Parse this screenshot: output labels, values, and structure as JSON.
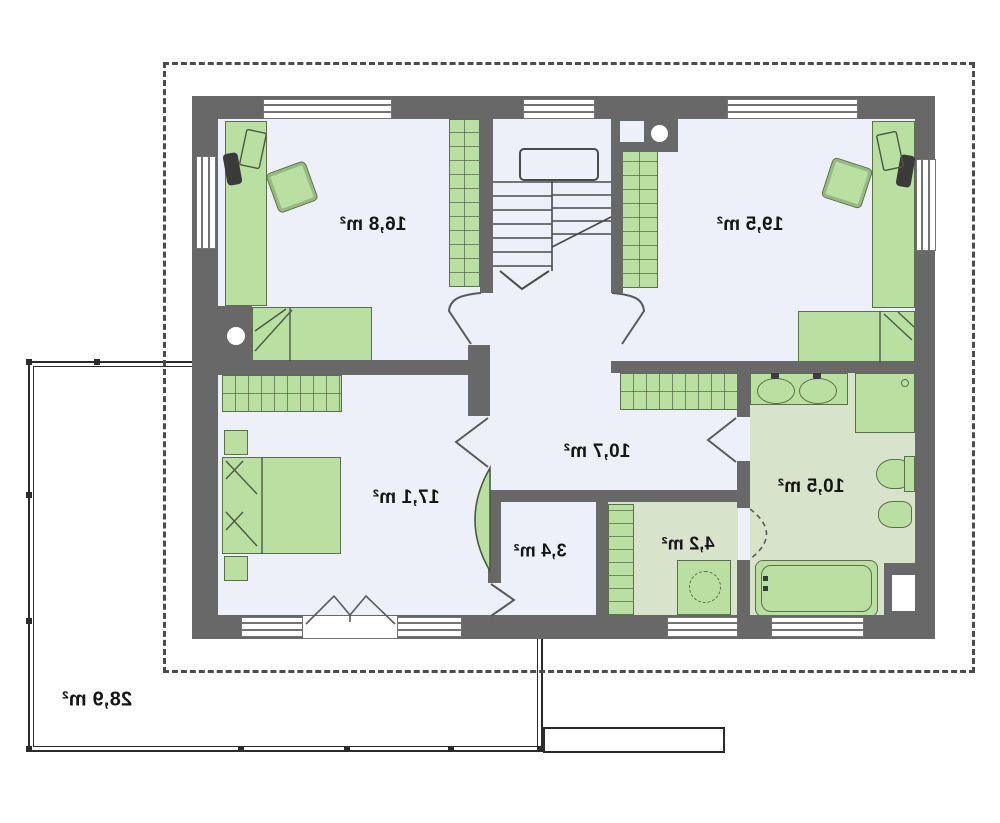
{
  "floor_plan": {
    "room_labels": [
      {
        "id": "room-top-left",
        "area": "16,8 m²"
      },
      {
        "id": "room-top-right",
        "area": "19,5 m²"
      },
      {
        "id": "room-bottom-left",
        "area": "17,1 m²"
      },
      {
        "id": "hall",
        "area": "10,7 m²"
      },
      {
        "id": "bathroom",
        "area": "10,5 m²"
      },
      {
        "id": "closet",
        "area": "3,4 m²"
      },
      {
        "id": "utility",
        "area": "4,2 m²"
      },
      {
        "id": "terrace",
        "area": "28,9 m²"
      }
    ],
    "text_mirrored": true,
    "colors": {
      "wall": "#686868",
      "room_floor": "#edf0f8",
      "wet_room_floor": "#d8e3cc",
      "furniture_fill": "#b9e0a1",
      "furniture_outline": "#5a7048",
      "thin_lines": "#4a4a4a",
      "label_text": "#161616",
      "roof_dash": "#4b4b4b",
      "terrace_rail": "#2b2b2b"
    }
  }
}
